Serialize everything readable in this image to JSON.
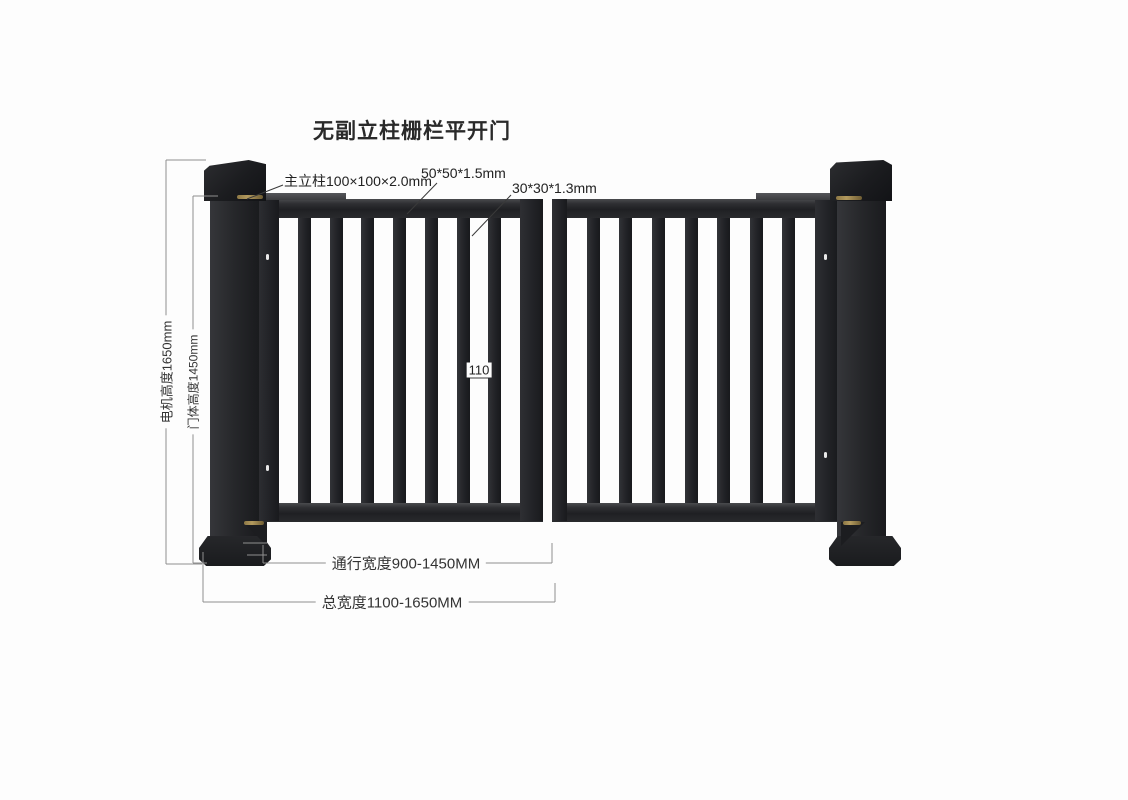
{
  "title": "无副立柱栅栏平开门",
  "callouts": {
    "main_post": "主立柱100×100×2.0mm",
    "frame_tube": "50*50*1.5mm",
    "picket_tube": "30*30*1.3mm",
    "picket_gap": "110"
  },
  "dimensions": {
    "motor_height": "电机高度1650mm",
    "door_height": "门体高度1450mm",
    "passage_width": "通行宽度900-1450MM",
    "total_width": "总宽度1100-1650MM"
  },
  "colors": {
    "gate_steel": "#232428",
    "dimension_line": "#8f8f8f",
    "leader_line": "#3a3a3a",
    "hinge_brass": "#8d7845",
    "text": "#2a2a2a",
    "background": "#fdfdfd"
  }
}
